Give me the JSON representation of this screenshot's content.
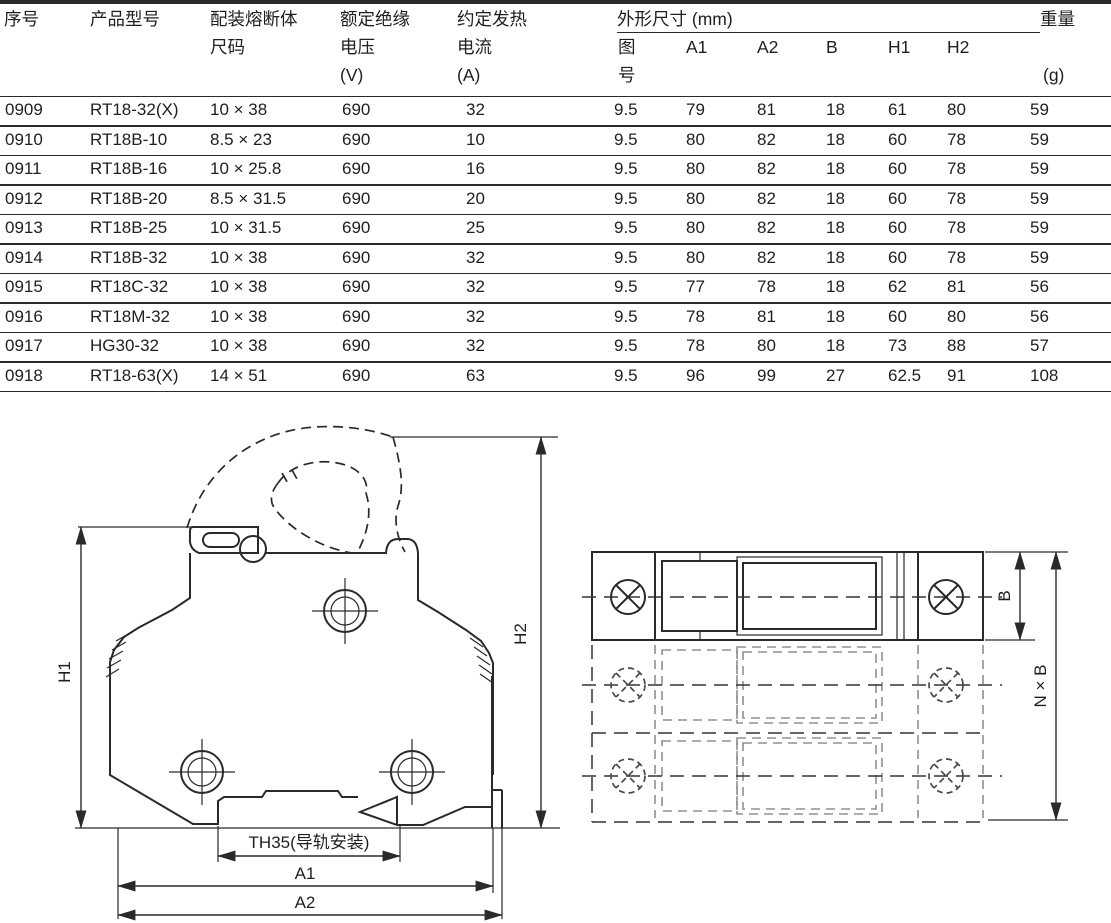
{
  "table": {
    "group_header": "外形尺寸 (mm)",
    "headers": {
      "serial": "序号",
      "model": "产品型号",
      "fuse_size_1": "配装熔断体",
      "fuse_size_2": "尺码",
      "voltage_1": "额定绝缘",
      "voltage_2": "电压",
      "voltage_3": "(V)",
      "current_1": "约定发热",
      "current_2": "电流",
      "current_3": "(A)",
      "figure_1": "图",
      "figure_2": "号",
      "a1": "A1",
      "a2": "A2",
      "b": "B",
      "h1": "H1",
      "h2": "H2",
      "weight_1": "重量",
      "weight_3": "(g)"
    },
    "rows": [
      [
        "0909",
        "RT18-32(X)",
        "10 × 38",
        "690",
        "32",
        "9.5",
        "79",
        "81",
        "18",
        "61",
        "80",
        "59"
      ],
      [
        "0910",
        "RT18B-10",
        "8.5 × 23",
        "690",
        "10",
        "9.5",
        "80",
        "82",
        "18",
        "60",
        "78",
        "59"
      ],
      [
        "0911",
        "RT18B-16",
        "10 × 25.8",
        "690",
        "16",
        "9.5",
        "80",
        "82",
        "18",
        "60",
        "78",
        "59"
      ],
      [
        "0912",
        "RT18B-20",
        "8.5 × 31.5",
        "690",
        "20",
        "9.5",
        "80",
        "82",
        "18",
        "60",
        "78",
        "59"
      ],
      [
        "0913",
        "RT18B-25",
        "10 × 31.5",
        "690",
        "25",
        "9.5",
        "80",
        "82",
        "18",
        "60",
        "78",
        "59"
      ],
      [
        "0914",
        "RT18B-32",
        "10 × 38",
        "690",
        "32",
        "9.5",
        "80",
        "82",
        "18",
        "60",
        "78",
        "59"
      ],
      [
        "0915",
        "RT18C-32",
        "10 × 38",
        "690",
        "32",
        "9.5",
        "77",
        "78",
        "18",
        "62",
        "81",
        "56"
      ],
      [
        "0916",
        "RT18M-32",
        "10 × 38",
        "690",
        "32",
        "9.5",
        "78",
        "81",
        "18",
        "60",
        "80",
        "56"
      ],
      [
        "0917",
        "HG30-32",
        "10 × 38",
        "690",
        "32",
        "9.5",
        "78",
        "80",
        "18",
        "73",
        "88",
        "57"
      ],
      [
        "0918",
        "RT18-63(X)",
        "14 × 51",
        "690",
        "63",
        "9.5",
        "96",
        "99",
        "27",
        "62.5",
        "91",
        "108"
      ]
    ]
  },
  "diagrams": {
    "front_view": {
      "h1_label": "H1",
      "h2_label": "H2",
      "a1_label": "A1",
      "a2_label": "A2",
      "rail_label": "TH35(导轨安装)"
    },
    "top_view": {
      "b_label": "B",
      "nxb_label": "N × B"
    }
  },
  "colors": {
    "line": "#2a2a2a",
    "text": "#1f1f1f",
    "ghost": "#909090",
    "background": "#ffffff"
  }
}
